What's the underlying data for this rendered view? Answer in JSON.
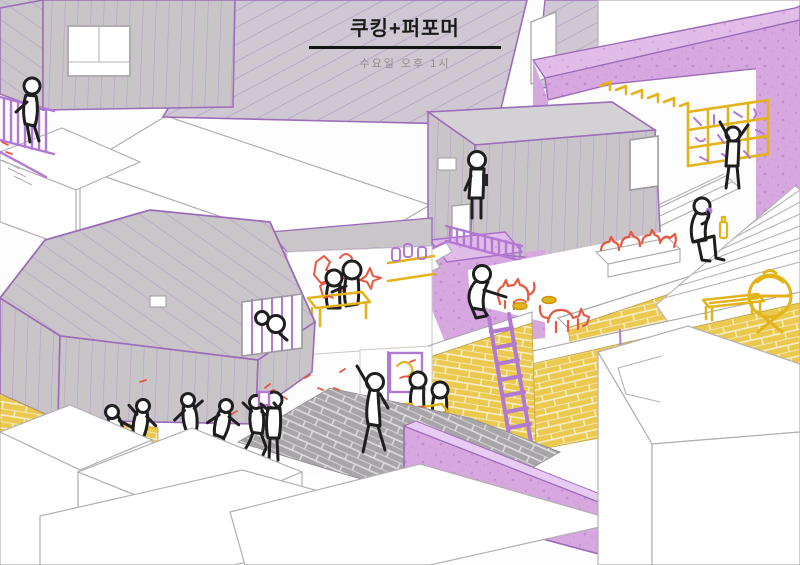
{
  "poster": {
    "title": "쿠킹+퍼포머",
    "subtitle": "수요일 오후 1시"
  },
  "palette": {
    "background": "#fdfdfd",
    "roof_hatch_grey": "#cfc8d2",
    "hatch_line_purple": "#b18fc6",
    "wall_grey": "#c8c4c8",
    "siding_stripe_purple": "#b79cc9",
    "purple_texture": "#d7a7e0",
    "purple_texture_light": "#e2bce9",
    "brick_yellow": "#eac94e",
    "brick_mortar": "#f6efd2",
    "pavement_grey": "#a8a5a8",
    "sketch_red": "#e85840",
    "sketch_yellow": "#e3b31b",
    "sketch_purple": "#b279d2",
    "outline_black": "#1e1e1e",
    "title_black": "#1a1a1a",
    "subtitle_grey": "#8f8c90"
  },
  "scene": {
    "style": "isometric-village-illustration",
    "elements": [
      "title-roof",
      "striped-grey-houses",
      "purple-textured-walls",
      "yellow-brick-walls",
      "grey-brick-pavement",
      "white-outline-buildings",
      "balcony-figure",
      "shelf-climbing-figure",
      "balcony-standing-figure",
      "cat-feeding-figure",
      "stairs-eating-figure",
      "window-peeking-figures",
      "cooking-table-figures",
      "dining-table-figures",
      "waving-figure",
      "camera-figure",
      "dancing-figures",
      "red-sketched-cats",
      "purple-ladder",
      "yellow-shelf",
      "yellow-bbq-grill",
      "yellow-bench",
      "picture-frame",
      "red-food-doodles",
      "white-staircases"
    ]
  }
}
